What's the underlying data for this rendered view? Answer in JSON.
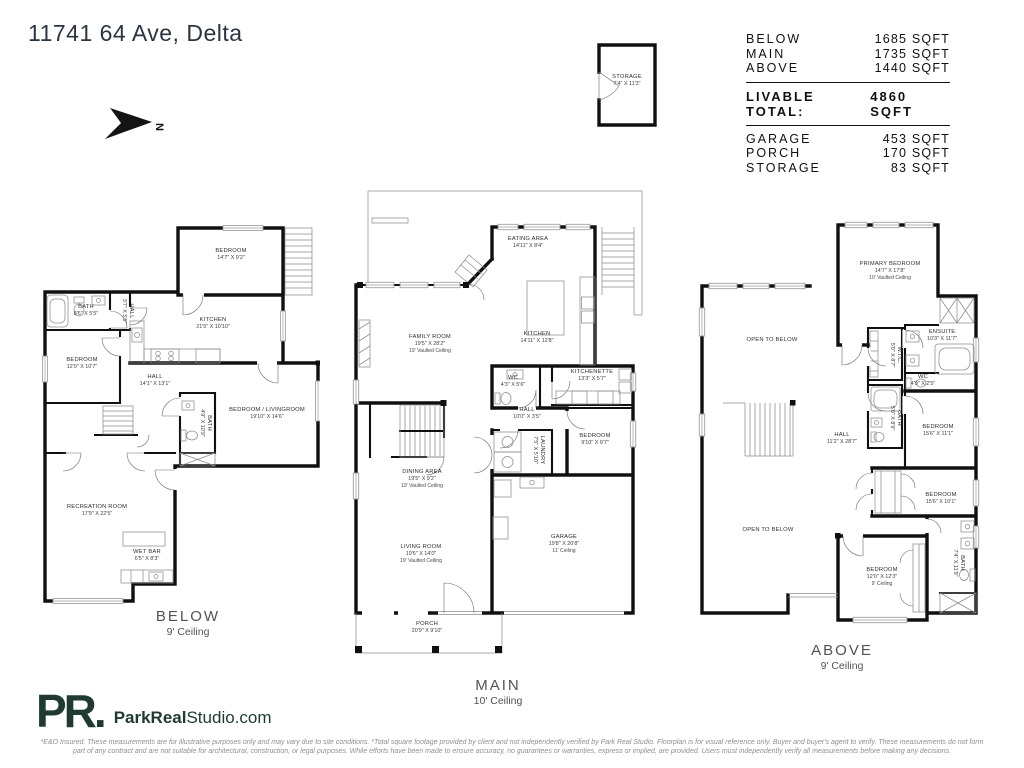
{
  "page": {
    "title": "11741 64 Ave, Delta"
  },
  "north": {
    "label": "N"
  },
  "storage_box": {
    "name": "STORAGE",
    "dims": "7'4\" X 11'3\""
  },
  "area_table": {
    "rows": [
      {
        "label": "BELOW",
        "value": "1685 SQFT"
      },
      {
        "label": "MAIN",
        "value": "1735 SQFT"
      },
      {
        "label": "ABOVE",
        "value": "1440 SQFT"
      }
    ],
    "total": {
      "label": "LIVABLE TOTAL:",
      "value": "4860 SQFT"
    },
    "extras": [
      {
        "label": "GARAGE",
        "value": "453 SQFT"
      },
      {
        "label": "PORCH",
        "value": "170 SQFT"
      },
      {
        "label": "STORAGE",
        "value": "83 SQFT"
      }
    ]
  },
  "plans": {
    "below": {
      "label": "BELOW",
      "ceiling": "9' Ceiling",
      "rooms": [
        {
          "name": "BEDROOM",
          "dims": "14'7\" X 9'2\""
        },
        {
          "name": "BATH",
          "dims": "8'6\" X 5'5\""
        },
        {
          "name": "HALL",
          "dims": "3'7\" X 5'5\""
        },
        {
          "name": "KITCHEN",
          "dims": "21'5\" X 10'10\""
        },
        {
          "name": "BEDROOM",
          "dims": "12'0\" X 10'7\""
        },
        {
          "name": "HALL",
          "dims": "14'1\" X 13'1\""
        },
        {
          "name": "BEDROOM / LIVINGROOM",
          "dims": "19'10\" X 14'6\""
        },
        {
          "name": "BATH",
          "dims": "4'9\" X 10'9\""
        },
        {
          "name": "RECREATION ROOM",
          "dims": "17'9\" X 22'5\""
        },
        {
          "name": "WET BAR",
          "dims": "6'5\" X 8'3\""
        }
      ]
    },
    "main": {
      "label": "MAIN",
      "ceiling": "10' Ceiling",
      "rooms": [
        {
          "name": "EATING AREA",
          "dims": "14'11\" X 8'4\""
        },
        {
          "name": "FAMILY ROOM",
          "dims": "19'5\" X 28'2\"",
          "note": "19' Vaulted Ceiling"
        },
        {
          "name": "KITCHEN",
          "dims": "14'11\" X 12'8\""
        },
        {
          "name": "WC",
          "dims": "4'3\" X 5'6\""
        },
        {
          "name": "KITCHENETTE",
          "dims": "13'3\" X 5'7\""
        },
        {
          "name": "HALL",
          "dims": "10'0\" X 3'5\""
        },
        {
          "name": "LAUNDRY",
          "dims": "7'5\" X 5'10\""
        },
        {
          "name": "BEDROOM",
          "dims": "9'10\" X 9'7\""
        },
        {
          "name": "DINING AREA",
          "dims": "19'5\" X 9'2\"",
          "note": "19' Vaulted Ceiling"
        },
        {
          "name": "LIVING ROOM",
          "dims": "19'6\" X 14'0\"",
          "note": "19' Vaulted Ceiling"
        },
        {
          "name": "GARAGE",
          "dims": "19'8\" X 20'8\"",
          "note": "11' Ceiling"
        },
        {
          "name": "PORCH",
          "dims": "20'9\" X 9'10\""
        }
      ]
    },
    "above": {
      "label": "ABOVE",
      "ceiling": "9' Ceiling",
      "rooms": [
        {
          "name": "PRIMARY BEDROOM",
          "dims": "14'7\" X 17'8\"",
          "note": "10' Vaulted Ceiling"
        },
        {
          "name": "OPEN TO BELOW",
          "dims": ""
        },
        {
          "name": "W.I.C.",
          "dims": "5'0\" X 8'7\""
        },
        {
          "name": "ENSUITE",
          "dims": "10'3\" X 11'7\""
        },
        {
          "name": "WC",
          "dims": "4'9\" X 2'5\""
        },
        {
          "name": "BATH",
          "dims": "5'0\" X 8'9\""
        },
        {
          "name": "HALL",
          "dims": "11'2\" X 28'7\""
        },
        {
          "name": "BEDROOM",
          "dims": "15'6\" X 11'1\""
        },
        {
          "name": "BEDROOM",
          "dims": "15'6\" X 10'1\""
        },
        {
          "name": "OPEN TO BELOW",
          "dims": ""
        },
        {
          "name": "BEDROOM",
          "dims": "12'0\" X 12'3\"",
          "note": "9' Ceiling"
        },
        {
          "name": "BATH",
          "dims": "7'4\" X 11'9\""
        }
      ]
    }
  },
  "footer": {
    "logo_mark": "PR.",
    "logo_name_bold": "ParkReal",
    "logo_name_rest": "Studio.com",
    "disclaimer_line1": "*E&O Insured. These measurements are for illustrative purposes only and may vary due to site conditions. *Total square footage provided by client and not independently verified by Park Real Studio. Floorplan is for visual reference only. Buyer and buyer's agent to verify. These measurements do not form",
    "disclaimer_line2": "part of any contract and are not suitable for architectural, construction, or legal purposes. While efforts have been made to ensure accuracy, no guarantees or warranties, express or implied, are provided. Users must independently verify all measurements before making any decisions."
  }
}
